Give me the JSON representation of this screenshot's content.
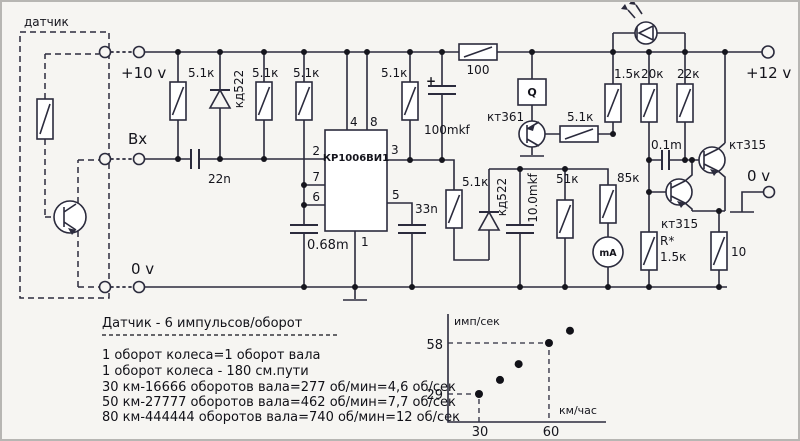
{
  "schematic": {
    "sensor_label": "датчик",
    "terminals": {
      "plus10": "+10 v",
      "vx": "Вх",
      "zero_left": "0 v",
      "plus12": "+12 v",
      "zero_right": "0 v"
    },
    "parts": {
      "r_top1": "5.1к",
      "d_top": "кд522",
      "r_top2": "5.1к",
      "r_top3": "5.1к",
      "r_top4": "5.1к",
      "c_in": "22n",
      "c_100mkf": "100mkf",
      "c_100mkf_plus": "+",
      "r_100": "100",
      "c_068": "0.68m",
      "c_33n": "33n",
      "r_51k_drv": "5.1к",
      "d_kd522_2": "кд522",
      "c_10mkf": "10.0mkf",
      "q_box": "Q",
      "t_kt361": "кт361",
      "r_out": "5.1к",
      "r_51k": "51к",
      "r_85k": "85к",
      "meter": "mA",
      "r_15k": "1.5к",
      "r_20k": "20к",
      "r_22k": "22к",
      "c_01m": "0.1m",
      "t_kt315_top": "кт315",
      "t_kt315_bot": "кт315",
      "r_star_name": "R*",
      "r_star_val": "1.5к",
      "r_10": "10"
    },
    "ic": {
      "name": "КР1006ВИ1",
      "pins": {
        "p1": "1",
        "p2": "2",
        "p3": "3",
        "p4": "4",
        "p5": "5",
        "p6": "6",
        "p7": "7",
        "p8": "8"
      }
    }
  },
  "notes": {
    "title": "Датчик - 6 импульсов/оборот",
    "lines": [
      "1 оборот колеса=1 оборот вала",
      "1 оборот колеса - 180 см.пути",
      "30 км-16666 оборотов вала=277 об/мин=4,6 об/сек",
      "50 км-27777 оборотов вала=462 об/мин=7,7 об/сек",
      "80 км-444444 оборотов вала=740 об/мин=12 об/сек"
    ]
  },
  "chart_data": {
    "type": "scatter",
    "xlabel": "км/час",
    "ylabel": "имп/сек",
    "xticks": [
      "30",
      "60"
    ],
    "yticks": [
      "29",
      "58"
    ],
    "xlim": [
      17,
      85
    ],
    "ylim": [
      13,
      75
    ],
    "grid": false,
    "points": [
      [
        30,
        29
      ],
      [
        39,
        37
      ],
      [
        47,
        46
      ],
      [
        60,
        58
      ],
      [
        69,
        65
      ]
    ],
    "dashed_guides": [
      [
        30,
        29
      ],
      [
        60,
        58
      ]
    ]
  }
}
